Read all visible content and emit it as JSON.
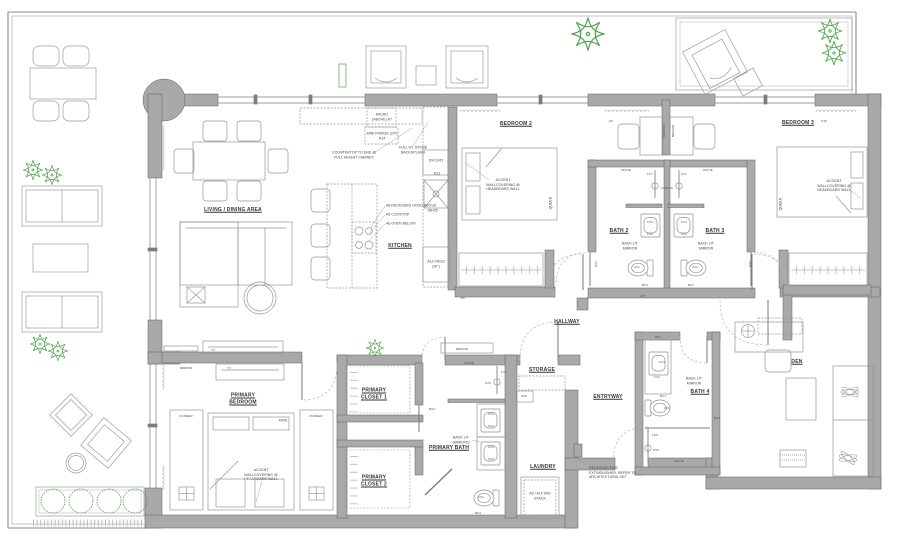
{
  "colors": {
    "wall": "#a9a9a9",
    "wall_edge": "#606060",
    "furniture_line": "#9c9c9c",
    "text": "#3c3c3c",
    "plant_green": "#4fa648"
  },
  "rooms": {
    "living": "LIVING / DINING AREA",
    "kitchen": "KITCHEN",
    "bedroom2": "BEDROOM 2",
    "bedroom3": "BEDROOM 3",
    "bath2": "BATH 2",
    "bath3": "BATH 3",
    "bath4": "BATH 4",
    "hallway": "HALLWAY",
    "primary_bedroom": "PRIMARY BEDROOM",
    "primary_closet1": "PRIMARY CLOSET 1",
    "primary_closet2": "PRIMARY CLOSET 2",
    "primary_bath": "PRIMARY BATH",
    "storage": "STORAGE",
    "laundry": "LAUNDRY",
    "entryway": "ENTRYWAY",
    "den": "DEN"
  },
  "kitchen_notes": {
    "micro": "MICRO (ABOVE) A7",
    "mini_fridge": "MINI FRIDGE (24\") A14",
    "countertop": "COUNTERTOP TO END @ FULL HEIGHT CABINET",
    "backsplash": "FULL HT. STONE BACKSPLASH",
    "hood": "A8 RECESSED HOOD ABOVE",
    "cooktop": "A5 COOKTOP",
    "oven": "A6 OVEN BELOW",
    "dw": "DW (24\")",
    "a13": "A13",
    "wh25": "WH25",
    "fridge": "A12 FR/SZ (30\")"
  },
  "notes": {
    "accent_wall": "ACCENT WALLCOVERING @ HEADBOARD WALL",
    "fire": "RECESSED FIRE EXTINGUISHER, REFER TO ARCHITECTURAL SET",
    "backlit_mirror": "BACK LIT MIRROR",
    "backlit_mirrors": "BACK LIT MIRRORS",
    "niche": "NICHE",
    "mirror": "MIRROR",
    "tv": "TV",
    "queen": "QUEEN",
    "king": "KING",
    "runner": "RUNNER",
    "wd_stack": "A9 / A10 W/D STACK",
    "wh": "W/H"
  },
  "tags": {
    "fx1": "FX1",
    "fx2": "FX2",
    "fx4": "FX4",
    "fx6": "FX6",
    "fx7": "FX7",
    "fx8": "FX8",
    "ba1": "BA1",
    "ba2": "BA2",
    "ba4": "BA4",
    "d6": "D6",
    "d18": "D18",
    "a87": "A87"
  }
}
